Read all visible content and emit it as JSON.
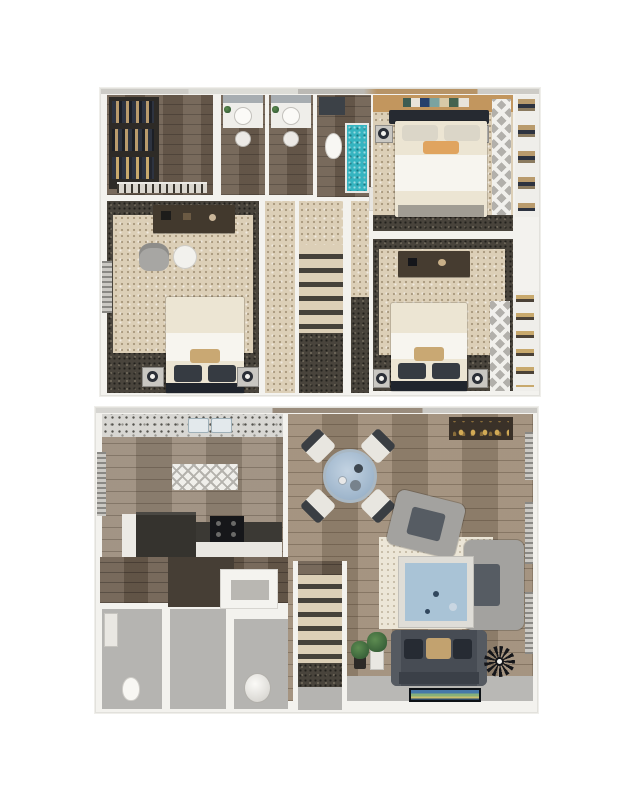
{
  "image": {
    "kind": "3D dollhouse two-level apartment floor plan rendering",
    "levels": 2,
    "background_color": "#ffffff"
  },
  "palette": {
    "wall_white": "#f3f2ee",
    "wall_edge": "#e2e1dc",
    "carpet_beige": "#dccfb7",
    "carpet_dark": "#49443c",
    "wood_dark": "#6e5f50",
    "wood_plank": "#9c8a75",
    "floor_gray": "#b5b4b1",
    "granite": "#d8d7d3",
    "teal_shower": "#35b4c0",
    "accent_wall_tan": "#c2965e",
    "pillow_orange": "#e0a45f",
    "bedding_cream": "#ece5d3",
    "bedding_white": "#f7f5ef",
    "pillow_tan": "#c9a873",
    "sofa_charcoal": "#474c54",
    "table_blue": "#9db8d2",
    "coffee_table_blue": "#a9c3d6",
    "rug_cream": "#ece6d7",
    "chair_gray": "#a3a29f",
    "counter_dark": "#35332e",
    "clothes_navy": "#2d3340",
    "clothes_tan": "#b99b6d",
    "plant_green": "#3f6b3a"
  },
  "floors": {
    "upper": {
      "label": "Upper level — bedrooms and bathrooms",
      "rooms": {
        "walk_in_closet": {
          "label": "Walk-in closet",
          "furniture": [
            "hanging clothes rack",
            "shoe shelf"
          ]
        },
        "vanity_left": {
          "label": "Vanity room (left)",
          "furniture": [
            "round vessel sink",
            "mirror",
            "potted plant"
          ]
        },
        "vanity_right": {
          "label": "Vanity room (right)",
          "furniture": [
            "round vessel sink",
            "mirror",
            "potted plant"
          ]
        },
        "bathroom": {
          "label": "Bathroom",
          "furniture": [
            "toilet",
            "teal tiled shower",
            "dark counter"
          ]
        },
        "master_bedroom": {
          "label": "Bedroom (top right)",
          "furniture": [
            "double bed with orange accent pillow",
            "two nightstands with lamps",
            "wall art",
            "tan accent wall",
            "louvered closet doors"
          ]
        },
        "closet_top_right": {
          "label": "Reach-in closet",
          "furniture": [
            "folded clothes shelves"
          ]
        },
        "hallway": {
          "label": "Hallway landing"
        },
        "stairs": {
          "label": "Staircase down"
        },
        "linen_shelf": {
          "label": "Linen shelf"
        },
        "bedroom_left": {
          "label": "Bedroom (left)",
          "furniture": [
            "double bed",
            "desk",
            "desk chair",
            "round side table",
            "two nightstands with lamps",
            "window blinds"
          ]
        },
        "bedroom_right": {
          "label": "Bedroom (bottom right)",
          "furniture": [
            "double bed",
            "desk",
            "two nightstands",
            "louvered closet doors"
          ]
        },
        "closet_bottom_right": {
          "label": "Reach-in closet",
          "furniture": [
            "shelving with baskets"
          ]
        }
      }
    },
    "lower": {
      "label": "Lower level — kitchen, dining and living room",
      "rooms": {
        "kitchen": {
          "label": "Kitchen",
          "furniture": [
            "granite counter with double sink",
            "island counter",
            "range stove",
            "chevron rug",
            "window blinds"
          ]
        },
        "dining": {
          "label": "Dining area",
          "furniture": [
            "round blue glass table",
            "four dining chairs"
          ]
        },
        "living": {
          "label": "Living room",
          "furniture": [
            "charcoal sofa with pillows",
            "two gray armchairs",
            "blue coffee table",
            "cream area rug",
            "wall-mounted TV",
            "starburst wall clock",
            "floor plant",
            "console table with bottles",
            "window blinds"
          ]
        },
        "stairs": {
          "label": "Staircase up",
          "furniture": [
            "potted plant"
          ]
        },
        "powder_room": {
          "label": "Bathroom",
          "furniture": [
            "toilet",
            "vanity"
          ]
        },
        "hall": {
          "label": "Hallway"
        },
        "utility": {
          "label": "Utility closet",
          "furniture": [
            "water heater",
            "storage console"
          ]
        }
      }
    }
  }
}
